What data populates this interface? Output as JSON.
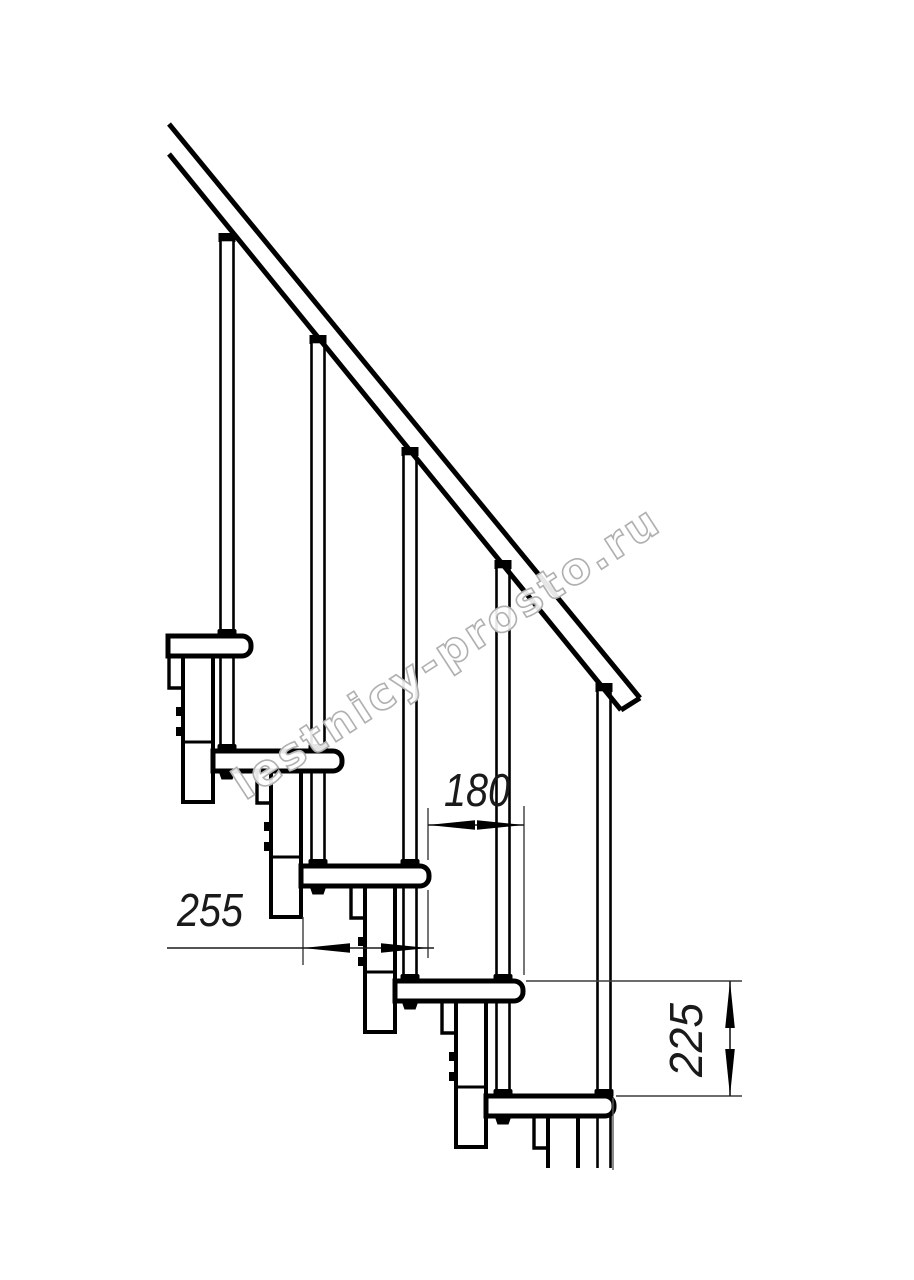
{
  "drawing": {
    "type": "technical side view of a modular staircase with handrail",
    "steps_count": 5,
    "balusters_count": 5,
    "watermark": {
      "text": "lestnicy-prosto.ru",
      "color": "#b0b0b0"
    },
    "dims": {
      "d180": "180",
      "d255": "255",
      "d225": "225"
    },
    "dim_meaning": {
      "d180": "horizontal going between step noses",
      "d255": "full tread depth",
      "d225": "vertical rise between treads"
    },
    "colors": {
      "line": "#000000",
      "dim_line": "#3c3c3c",
      "background": "#ffffff"
    }
  }
}
